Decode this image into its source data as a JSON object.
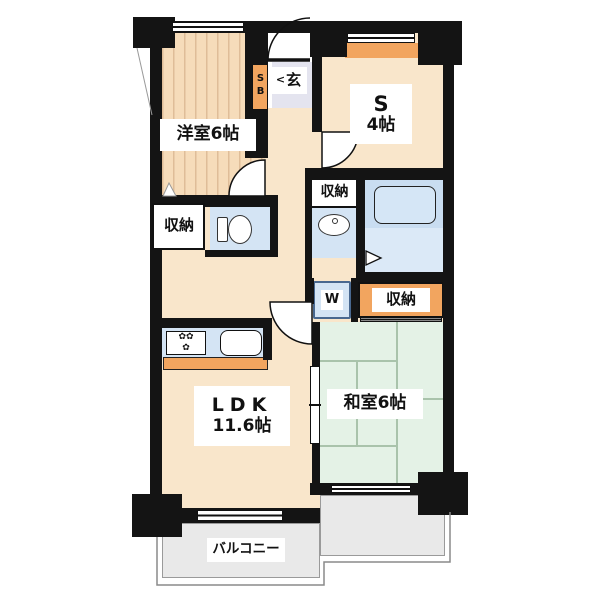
{
  "plan_title": "apartment-floor-plan",
  "rooms": {
    "western": {
      "label": "洋室6帖"
    },
    "service": {
      "name": "S",
      "size": "4帖"
    },
    "ldk": {
      "name": "LDK",
      "size": "11.6帖"
    },
    "japanese": {
      "label": "和室6帖"
    },
    "balcony": {
      "label": "バルコニー"
    },
    "entrance": {
      "arrow": "<",
      "label": "玄"
    },
    "shoe_box": {
      "label": "SB"
    },
    "washer": {
      "label": "W"
    },
    "storage_hall": {
      "label": "収納"
    },
    "storage_west": {
      "label": "収納"
    },
    "storage_east": {
      "label": "収納"
    }
  },
  "icons": {
    "stove_burner": "✿"
  },
  "colors": {
    "wall": "#141414",
    "floor": "#f9e6cb",
    "orange": "#f2a55f",
    "tatami": "#e4f2e6",
    "wet": "#d4e4f4",
    "balcony": "#e9e9e9",
    "genkan": "#e4e4ef"
  }
}
